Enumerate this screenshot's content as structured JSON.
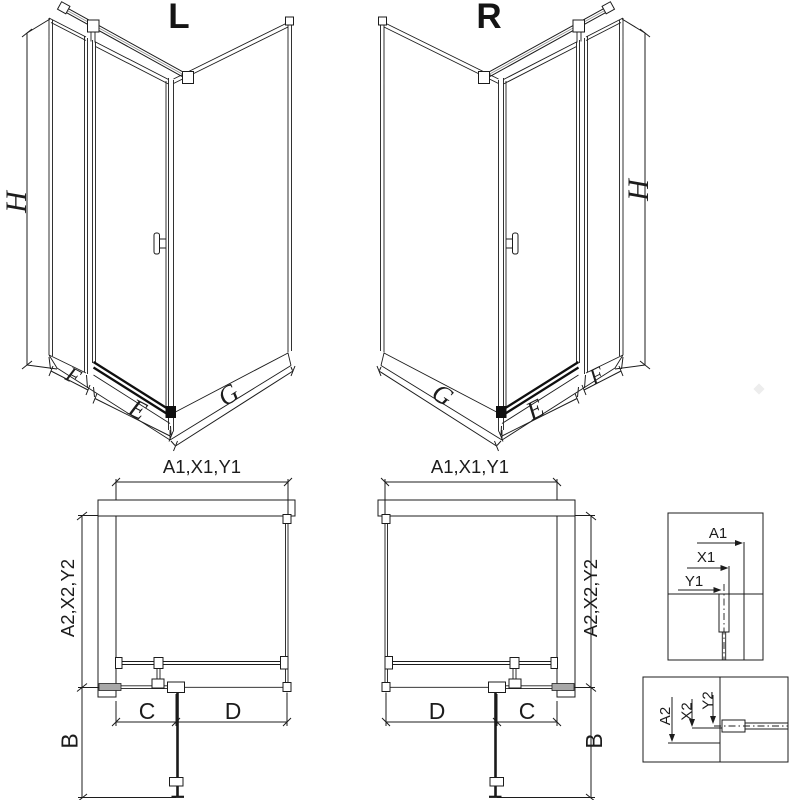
{
  "colors": {
    "line": "#1c1c1c",
    "dark": "#0f0f0f",
    "profile_gray": "#a8a8a8",
    "hatch": "#3f3f3f",
    "background": "#ffffff"
  },
  "iso_views": {
    "left": {
      "variant": "L",
      "height": "H",
      "side_panel": "F",
      "door": "E",
      "return_panel": "G"
    },
    "right": {
      "variant": "R",
      "height": "H",
      "side_panel": "F",
      "door": "E",
      "return_panel": "G"
    }
  },
  "plan_views": {
    "left": {
      "width": "A1,X1,Y1",
      "depth": "A2,X2,Y2",
      "swing": "B",
      "fixed_section": "C",
      "door_section": "D"
    },
    "right": {
      "width": "A1,X1,Y1",
      "depth": "A2,X2,Y2",
      "swing": "B",
      "fixed_section": "C",
      "door_section": "D"
    }
  },
  "details": {
    "wall_profile_plan": {
      "dims": [
        "A1",
        "X1",
        "Y1"
      ]
    },
    "wall_profile_section": {
      "dims": [
        "A2",
        "X2",
        "Y2"
      ]
    }
  }
}
